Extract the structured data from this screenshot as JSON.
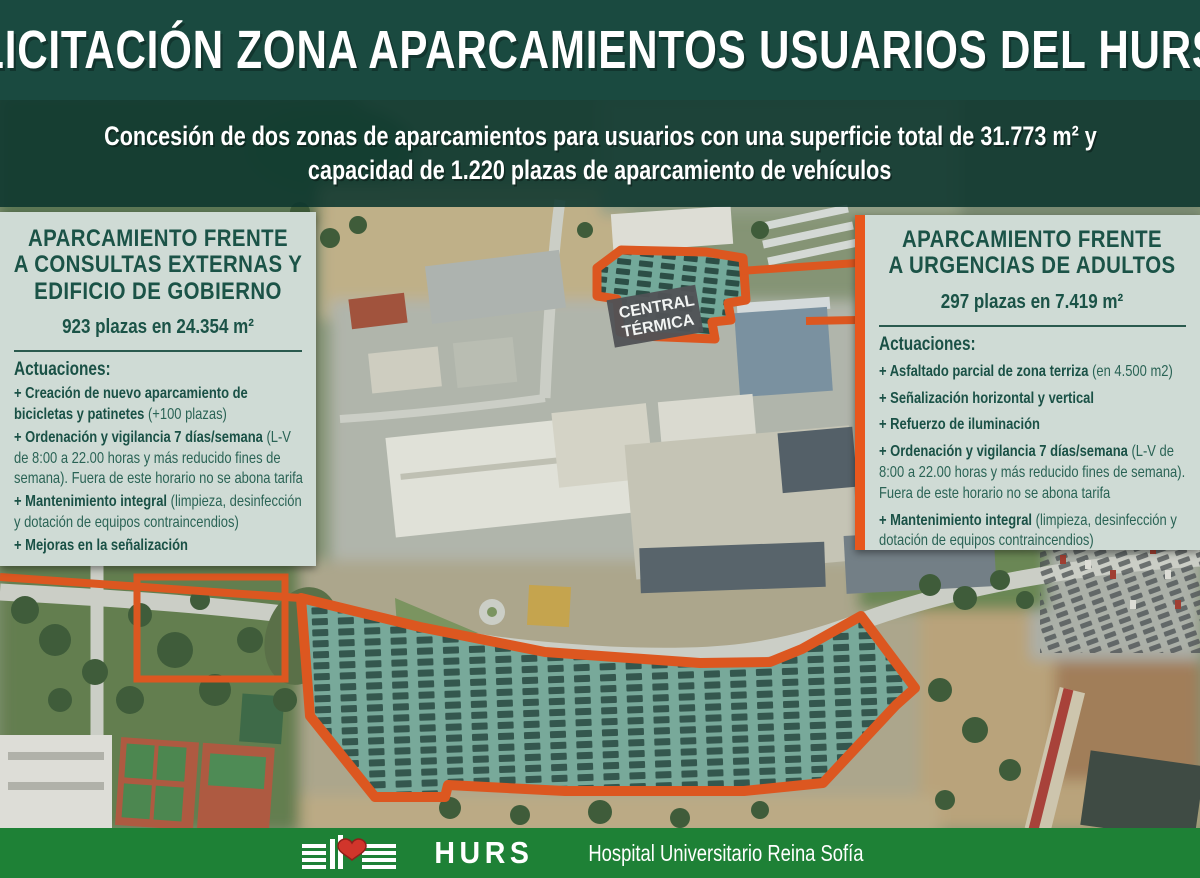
{
  "header": {
    "title": "LICITACIÓN ZONA APARCAMIENTOS USUARIOS DEL HURS"
  },
  "subtitle": {
    "line1": "Concesión de dos zonas de aparcamientos para usuarios con una superficie total de 31.773 m² y",
    "line2": "capacidad de 1.220 plazas de aparcamiento de vehículos"
  },
  "left_panel": {
    "title_line1": "APARCAMIENTO FRENTE",
    "title_line2": "A CONSULTAS EXTERNAS Y",
    "title_line3": "EDIFICIO DE GOBIERNO",
    "capacity": "923 plazas en 24.354 m²",
    "actions_label": "Actuaciones:",
    "actions": [
      {
        "bold": "+ Creación de nuevo aparcamiento de bicicletas y patinetes",
        "rest": " (+100 plazas)"
      },
      {
        "bold": "+ Ordenación y vigilancia 7 días/semana",
        "rest": " (L-V de 8:00 a 22.00 horas y más reducido fines de semana). Fuera de este horario no se abona tarifa"
      },
      {
        "bold": "+ Mantenimiento integral",
        "rest": " (limpieza, desinfección y dotación de equipos contraincendios)"
      },
      {
        "bold": "+ Mejoras en la señalización",
        "rest": ""
      }
    ]
  },
  "right_panel": {
    "title_line1": "APARCAMIENTO FRENTE",
    "title_line2": "A URGENCIAS DE ADULTOS",
    "capacity": "297 plazas en 7.419 m²",
    "actions_label": "Actuaciones:",
    "actions": [
      {
        "bold": "+ Asfaltado parcial de zona terriza",
        "rest": " (en 4.500 m2)"
      },
      {
        "bold": "+ Señalización horizontal y vertical",
        "rest": ""
      },
      {
        "bold": "+ Refuerzo de iluminación",
        "rest": ""
      },
      {
        "bold": "+ Ordenación y vigilancia 7 días/semana",
        "rest": " (L-V de 8:00 a 22.00 horas y más reducido fines de semana). Fuera de este horario no se abona tarifa"
      },
      {
        "bold": "+ Mantenimiento integral",
        "rest": " (limpieza, desinfección y dotación de equipos contraincendios)"
      }
    ]
  },
  "map": {
    "central_label_line1": "CENTRAL",
    "central_label_line2": "TÉRMICA"
  },
  "footer": {
    "acronym": "HURS",
    "name": "Hospital Universitario Reina Sofía"
  },
  "colors": {
    "header_green": "#1a4a40",
    "overlay_green": "#0d362e",
    "panel_bg": "#cfdbd5",
    "panel_text": "#1b5347",
    "highlight_orange": "#e8571d",
    "zone_teal": "#2e9b85",
    "footer_green": "#1e8136",
    "heart_red": "#d1352b"
  }
}
